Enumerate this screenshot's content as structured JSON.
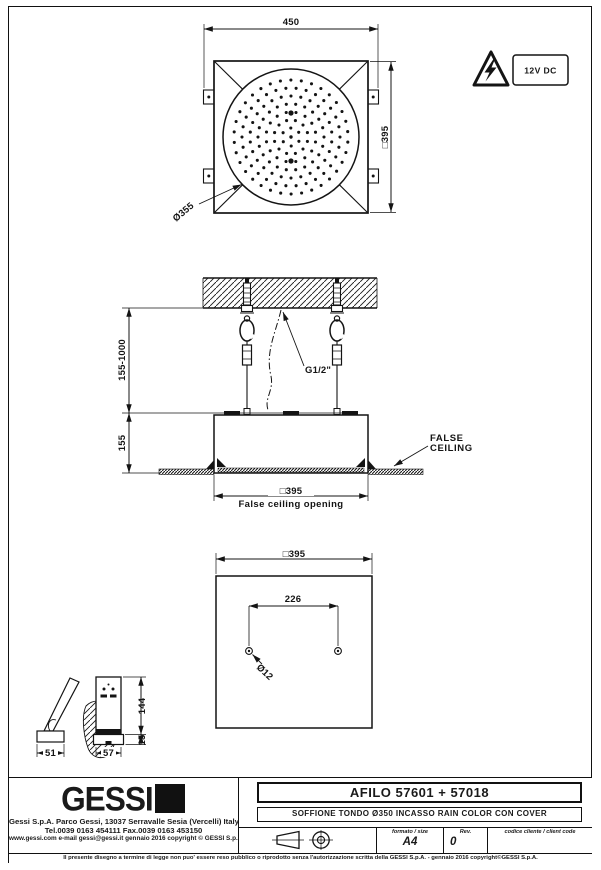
{
  "drawing": {
    "warning_label": "12V DC",
    "top_view": {
      "width": "450",
      "square": "□395",
      "diameter": "Ø355"
    },
    "section": {
      "drop_range": "155-1000",
      "recess_height": "155",
      "connection": "G1/2\"",
      "false_ceiling": [
        "FALSE",
        "CEILING"
      ],
      "opening_square": "□395",
      "opening_caption": "False  ceiling  opening"
    },
    "bottom_view": {
      "square": "□395",
      "hole_spacing": "226",
      "hole_diameter": "Ø12"
    },
    "remote": {
      "depth": "51",
      "width": "57",
      "height": "144",
      "base": "15"
    }
  },
  "footer": {
    "brand": "GESSI",
    "address_line1": "Gessi  S.p.A.  Parco  Gessi,  13037  Serravalle  Sesia  (Vercelli)  Italy",
    "address_line2": "Tel.0039  0163  454111  Fax.0039  0163  453150",
    "address_line3": "www.gessi.com  e-mail  gessi@gessi.it    gennaio  2016    copyright © GESSI  S.p.A.",
    "title": "AFILO  57601 + 57018",
    "subtitle": "SOFFIONE TONDO Ø350 INCASSO RAIN COLOR CON COVER",
    "format_label": "formato / size",
    "format_value": "A4",
    "rev_label": "Rev.",
    "rev_value": "0",
    "client_label": "codice cliente / client code",
    "client_value": "",
    "disclaimer": "Il presente disegno a termine di legge non puo' essere reso pubblico o riprodotto senza l'autorizzazione scritta della GESSI S.p.A.  -  gennaio 2016  copyright©GESSI S.p.A."
  }
}
